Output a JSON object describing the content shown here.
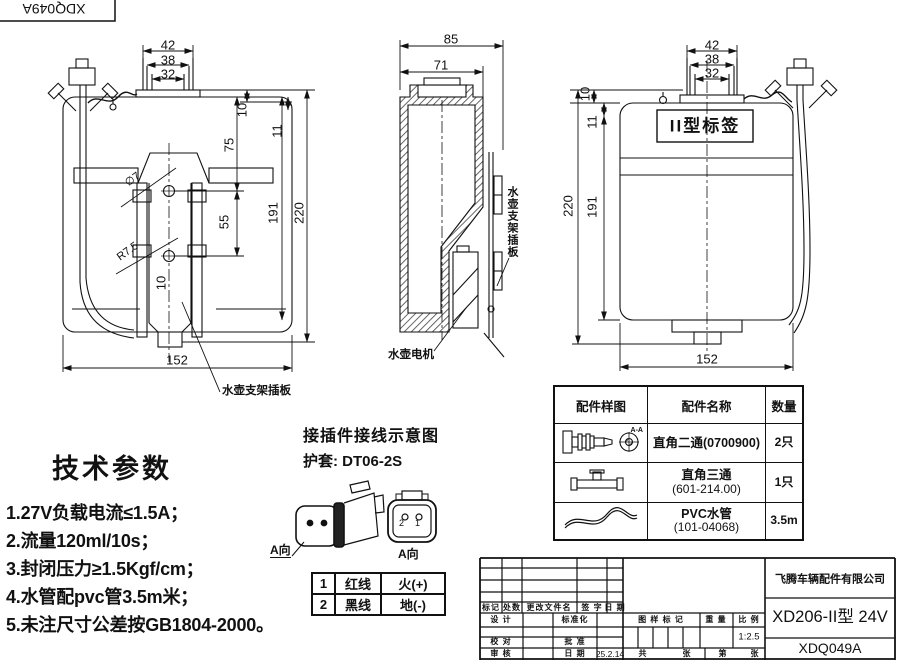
{
  "doc_box": {
    "number": "XDQ049A"
  },
  "front_view": {
    "dims": {
      "w42": "42",
      "w38": "38",
      "w32": "32",
      "h10": "10",
      "h11": "11",
      "h75": "75",
      "h55": "55",
      "h191": "191",
      "h220": "220",
      "w152": "152",
      "w10_inner": "10",
      "hole_dia": "∅7",
      "radius": "R7.5"
    },
    "bracket_label": "水壶支架插板"
  },
  "side_view": {
    "dims": {
      "w85": "85",
      "w71": "71"
    },
    "plate_label": "水壶支架插板",
    "motor_label": "水壶电机"
  },
  "rear_view": {
    "dims": {
      "w42": "42",
      "w38": "38",
      "w32": "32",
      "h10": "10",
      "h11": "11",
      "h191": "191",
      "h220": "220",
      "w152": "152"
    },
    "tag_label": "II型标签"
  },
  "tech_params": {
    "title": "技术参数",
    "items": [
      "1.27V负载电流≤1.5A；",
      "2.流量120ml/10s；",
      "3.封闭压力≥1.5Kgf/cm；",
      "4.水管配pvc管3.5m米；",
      "5.未注尺寸公差按GB1804-2000。"
    ]
  },
  "connector": {
    "title": "接插件接线示意图",
    "sheath": "护套: DT06-2S",
    "view_label_left": "A向",
    "view_label_right": "A向",
    "pin1": "1",
    "pin2": "2",
    "wire_table": {
      "rows": [
        [
          "1",
          "红线",
          "火(+)"
        ],
        [
          "2",
          "黑线",
          "地(-)"
        ]
      ]
    }
  },
  "parts_table": {
    "headers": [
      "配件样图",
      "配件名称",
      "数量"
    ],
    "rows": [
      {
        "icon": "elbow-fitting",
        "section_label": "A-A",
        "name": "直角二通(0700900)",
        "name2": "",
        "qty": "2只"
      },
      {
        "icon": "tee-fitting",
        "section_label": "",
        "name": "直角三通",
        "name2": "(601-214.00)",
        "qty": "1只"
      },
      {
        "icon": "pvc-tube",
        "section_label": "",
        "name": "PVC水管",
        "name2": "(101-04068)",
        "qty": "3.5m"
      }
    ]
  },
  "title_block": {
    "revision_headers": [
      "标记",
      "处数",
      "更改文件名",
      "签 字",
      "日 期"
    ],
    "design": "设 计",
    "standardization": "标准化",
    "check": "校 对",
    "approve": "批 准",
    "audit": "审 核",
    "date_label": "日 期",
    "date_value": "25.2.14",
    "stamp_label": "图 样 标 记",
    "weight_label": "重 量",
    "scale_label": "比 例",
    "scale_value": "1:2.5",
    "total_label": "共",
    "sheet_label": "张",
    "page_label": "第",
    "sheet_label2": "张",
    "company": "飞腾车辆配件有限公司",
    "model": "XD206-II型  24V",
    "drawing_no": "XDQ049A"
  }
}
